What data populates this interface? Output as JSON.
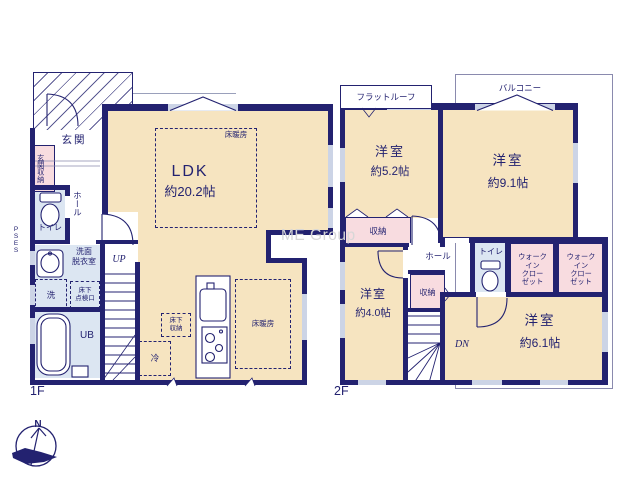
{
  "watermark": "ME Group",
  "compass": {
    "north": "N"
  },
  "colors": {
    "wall": "#232270",
    "room_fill": "#f6e4c0",
    "closet_fill": "#f8dce0",
    "wet_area_fill": "#dce6f2"
  },
  "f1": {
    "floor_label": "1F",
    "rooms": {
      "genkan": "玄関",
      "genkan_storage": "玄関収納",
      "hall": "ホール",
      "toilet": "トイレ",
      "washroom": "洗面\n脱衣室",
      "washer": "洗",
      "underfloor_hatch": "床下\n点検口",
      "bath": "UB",
      "stairs_up": "UP",
      "fridge": "冷",
      "underfloor_storage": "床下\n収納",
      "ldk": "LDK",
      "ldk_size": "約20.2帖",
      "floor_heating": "床暖房",
      "pipe_space": "P\nS\nE\nS"
    }
  },
  "f2": {
    "floor_label": "2F",
    "annotations": {
      "flat_roof": "フラットルーフ",
      "balcony": "バルコニー"
    },
    "rooms": {
      "west_room_52": "洋室",
      "west_room_52_size": "約5.2帖",
      "west_room_91": "洋室",
      "west_room_91_size": "約9.1帖",
      "storage_a": "収納",
      "storage_b": "収納",
      "hall": "ホール",
      "toilet": "トイレ",
      "wic_a": "ウォーク\nイン\nクロー\nゼット",
      "wic_b": "ウォーク\nイン\nクロー\nゼット",
      "west_room_40": "洋室",
      "west_room_40_size": "約4.0帖",
      "west_room_61": "洋室",
      "west_room_61_size": "約6.1帖",
      "stairs_down": "DN"
    }
  }
}
